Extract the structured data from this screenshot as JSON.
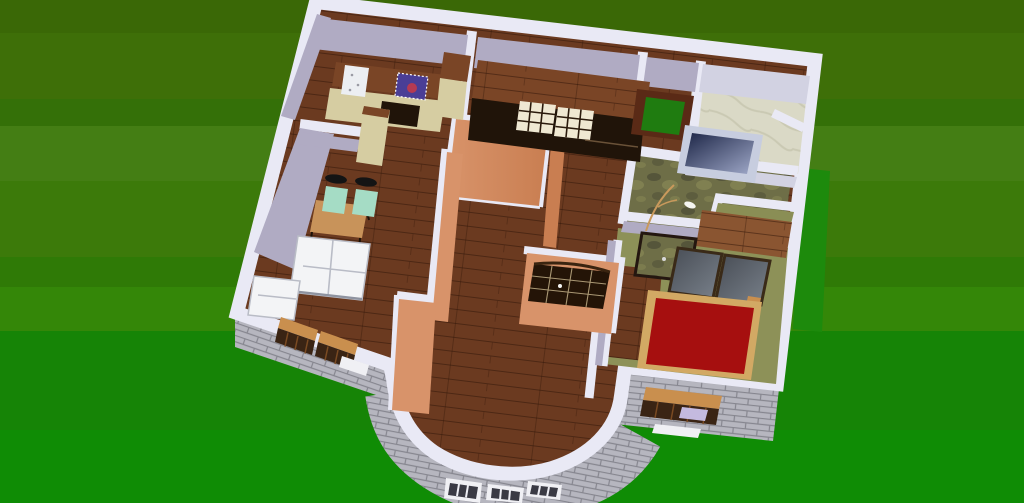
{
  "scene": {
    "description": "Aerial 3D rendering of a single-storey house floor plan, rotated slightly clockwise, sitting on a green lawn with horizontal mowing bands. No text or UI chrome is visible.",
    "rooms": [
      {
        "name": "kitchen",
        "furniture": [
          "wood-counter",
          "sink",
          "purple-cooktop-with-red-burner",
          "oven",
          "tall-cabinet"
        ]
      },
      {
        "name": "dining-room",
        "furniture": [
          "wood-dining-table",
          "mint-chair",
          "mint-chair",
          "white-sofa",
          "white-armchair"
        ]
      },
      {
        "name": "wardrobe-room",
        "furniture": [
          "dark-wardrobe-with-cream-drawers"
        ]
      },
      {
        "name": "hallway",
        "furniture": [
          "open-green-door",
          "glazed-double-door"
        ]
      },
      {
        "name": "bathroom",
        "furniture": [
          "navy-bathtub"
        ]
      },
      {
        "name": "patio",
        "furniture": [
          "plant-branch"
        ]
      },
      {
        "name": "bedroom",
        "furniture": [
          "red-double-bed",
          "stone-top-desk",
          "tinted-glass-table",
          "tinted-glass-table",
          "wood-bench"
        ]
      },
      {
        "name": "living-room",
        "furniture": [
          "curved-bay-wall-with-windows"
        ]
      }
    ],
    "exterior": [
      "grey-brick-south-walls",
      "wood-framed-windows",
      "white-bay-windows"
    ]
  },
  "colors": {
    "grass1": "#3a6806",
    "grass2": "#3e6f08",
    "grass3": "#347008",
    "grass4": "#447e14",
    "grass5": "#3c7a0a",
    "grass6": "#2f7a06",
    "grass7": "#348708",
    "grass8": "#168406",
    "grass9": "#0f8c05",
    "grassBright": "#1d8a0c",
    "wallTop": "#e9e9f5",
    "wallFace": "#b0abc3",
    "wallFaceLight": "#d2d2e2",
    "salmon": "#d8936a",
    "salmonDeep": "#c97e51",
    "wood": "#6b3a20",
    "woodLight": "#8a5531",
    "plank": "#2e1407",
    "brick": "#b6b6bf",
    "mortar": "#86868f",
    "marble": "#dad9c6",
    "marbleVein": "#c3c2ab",
    "camo": "#6e6e47",
    "camoDark": "#55553a",
    "camoLight": "#858554",
    "olive": "#8d9158",
    "oliveWall": "#8a8e55",
    "bedRed": "#a60f0f",
    "bedFrame": "#d2a964",
    "sofa": "#f3f4f6",
    "sofaSeam": "#b9bcc6",
    "mint": "#a5dcc5",
    "chairBack": "#141414",
    "table": "#c8935a",
    "beige": "#d6cda2",
    "cooktop": "#4a3e96",
    "burner": "#b53a52",
    "sink": "#eceef2",
    "wardrobeTop": "#7a4526",
    "wardrobeFront": "#201409",
    "drawer": "#efe8d2",
    "drawerLine": "#2a1a0c",
    "doorGreen": "#1f7c10",
    "doorFrame": "#5a2a16",
    "glazedDoor": "#241407",
    "paneLine": "#cbb88f",
    "glass": "#474c54",
    "glassLight": "#7a828c",
    "deskTop": "#98a089",
    "deskFrame": "#241710",
    "tubRim": "#c7cddf",
    "tubDeep": "#1c2546",
    "tubLight": "#9fa8c8",
    "winWood": "#c98f4e",
    "winBody": "#3a2414",
    "sill": "#f0f0f4",
    "towel": "#c4badf"
  }
}
